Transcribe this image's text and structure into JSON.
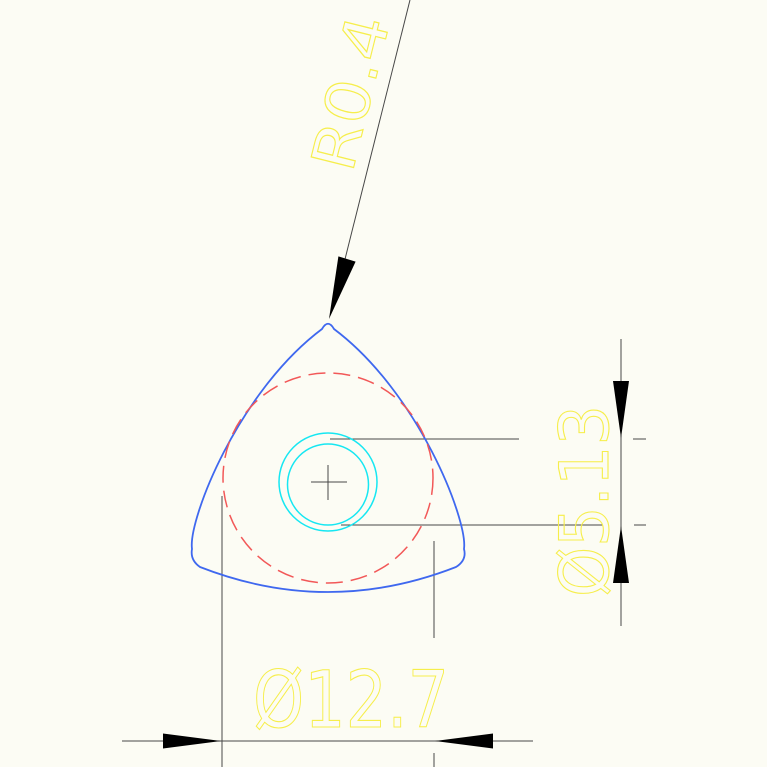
{
  "drawing": {
    "type": "cad-engineering-drawing",
    "part": "trochoid-rotor-profile",
    "labels": {
      "corner_radius": "R0.4",
      "vertical_dimension": "Ø5.13",
      "horizontal_dimension": "Ø12.7"
    },
    "colors": {
      "background": "#fcfcf4",
      "profile": "#3f68ef",
      "reference_circle": "#f25858",
      "bore": "#16e7f2",
      "dimension_text": "#f6ee4b",
      "lines": "#474747",
      "arrows": "#000000"
    }
  }
}
